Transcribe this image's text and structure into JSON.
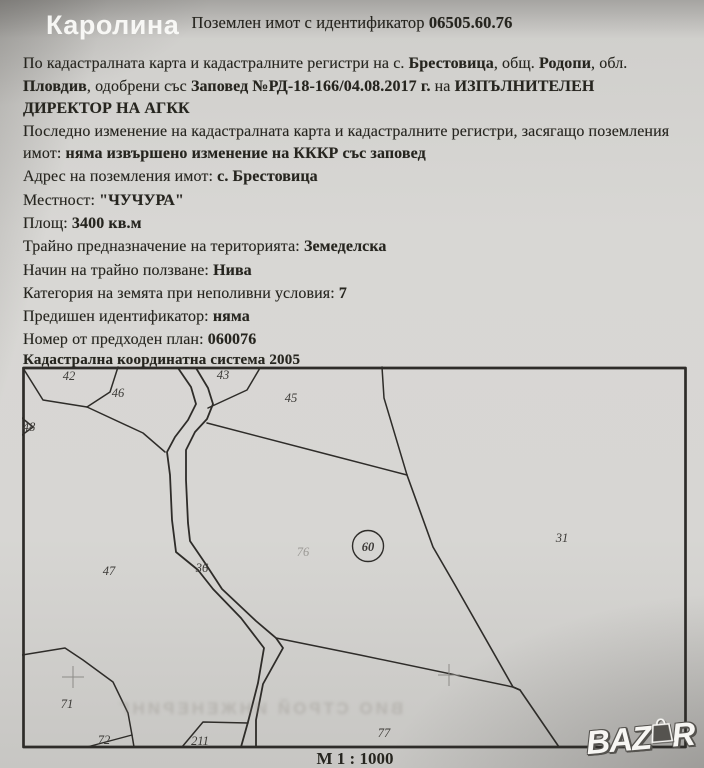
{
  "colors": {
    "paper": "#d5d4d1",
    "ink": "#26251f",
    "map_line": "#2e2c29",
    "watermark": "#fcfcfa"
  },
  "watermark": {
    "site_name": "Каролина",
    "logo_text_left": "BAZ",
    "logo_text_right": "R",
    "logo_icon": "shopping-bag-icon"
  },
  "bleedthrough_text": "ВИО СТРОЙ ИНЖЕНЕРИНГ",
  "doc": {
    "rows": [
      {
        "segs": [
          {
            "t": "Поземлен имот с идентификатор "
          },
          {
            "t": "06505.60.76"
          }
        ]
      },
      {
        "segs": [
          {
            "t": "По кадастралната карта и кадастралните регистри на с. "
          },
          {
            "t": "Брестовица"
          },
          {
            "t": ", общ. "
          },
          {
            "t": "Родопи"
          },
          {
            "t": ", обл."
          }
        ]
      },
      {
        "segs": [
          {
            "t": "Пловдив"
          },
          {
            "t": ", одобрени със "
          },
          {
            "t": "Заповед №РД-18-166/04.08.2017 г."
          },
          {
            "t": " на "
          },
          {
            "t": "ИЗПЪЛНИТЕЛЕН"
          }
        ]
      },
      {
        "segs": [
          {
            "t": "ДИРЕКТОР НА АГКК"
          }
        ]
      },
      {
        "segs": [
          {
            "t": "Последно изменение на кадастралната карта и кадастралните регистри, засягащо поземления"
          }
        ]
      },
      {
        "segs": [
          {
            "t": "имот: "
          },
          {
            "t": "няма извършено изменение на КККР със заповед"
          }
        ]
      },
      {
        "segs": [
          {
            "t": "Адрес на поземления имот: "
          },
          {
            "t": "с. Брестовица"
          }
        ]
      },
      {
        "segs": [
          {
            "t": "Местност: "
          },
          {
            "t": "\"ЧУЧУРА\""
          }
        ]
      },
      {
        "segs": [
          {
            "t": "Площ: "
          },
          {
            "t": "3400 кв.м"
          }
        ]
      },
      {
        "segs": [
          {
            "t": "Трайно предназначение на територията: "
          },
          {
            "t": "Земеделска"
          }
        ]
      },
      {
        "segs": [
          {
            "t": "Начин на трайно ползване: "
          },
          {
            "t": "Нива"
          }
        ]
      },
      {
        "segs": [
          {
            "t": "Категория на земята при неполивни условия: "
          },
          {
            "t": "7"
          }
        ]
      },
      {
        "segs": [
          {
            "t": "Предишен идентификатор: "
          },
          {
            "t": "няма"
          }
        ]
      },
      {
        "segs": [
          {
            "t": "Номер от предходен план: "
          },
          {
            "t": "060076"
          }
        ]
      }
    ],
    "map_header": "Кадастрална координатна система 2005",
    "scale": "М 1 : 1000"
  },
  "map": {
    "subject_parcel_circle": "60",
    "labels": [
      {
        "text": "42"
      },
      {
        "text": "46"
      },
      {
        "text": "43"
      },
      {
        "text": "45"
      },
      {
        "text": "48"
      },
      {
        "text": "31"
      },
      {
        "text": "76"
      },
      {
        "text": "47"
      },
      {
        "text": "36"
      },
      {
        "text": "71"
      },
      {
        "text": "72"
      },
      {
        "text": "211"
      },
      {
        "text": "77"
      }
    ]
  }
}
